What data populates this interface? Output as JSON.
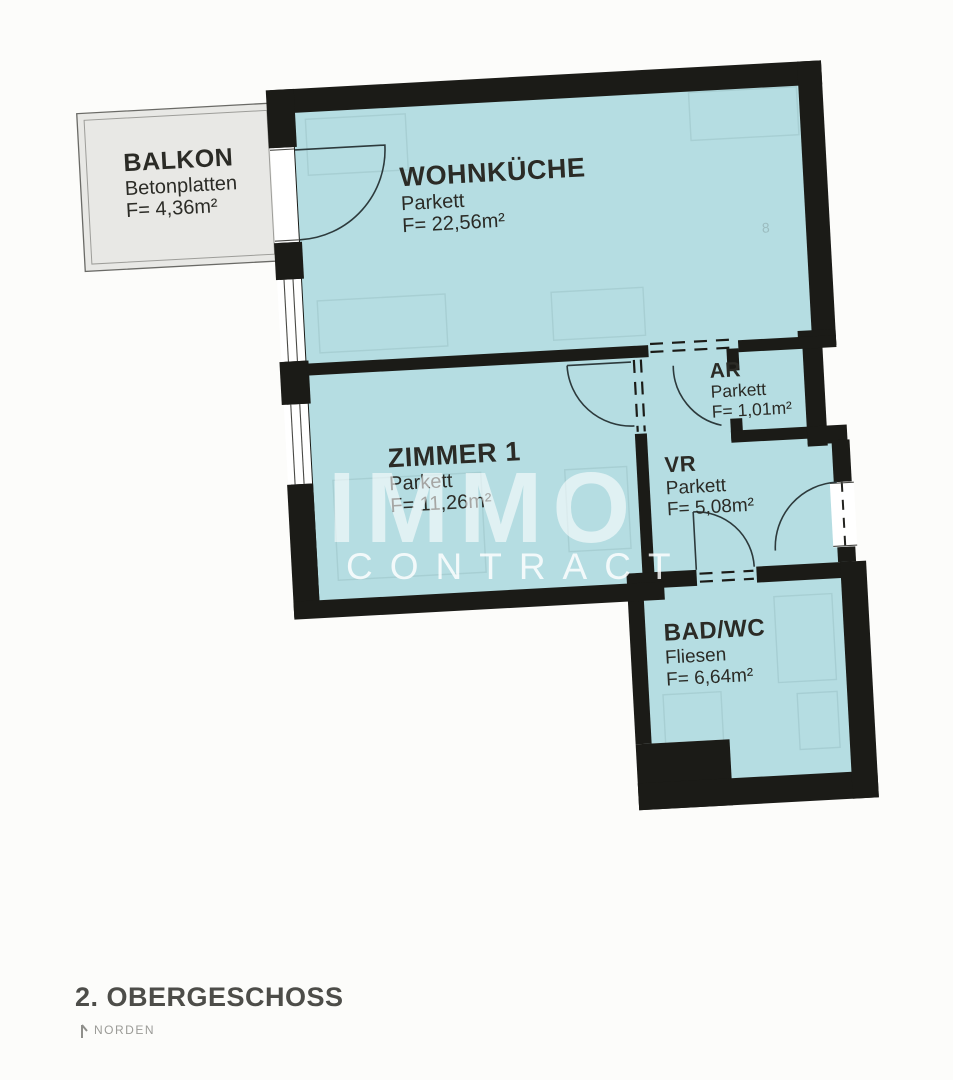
{
  "plan": {
    "watermark": {
      "primary": "IMMO",
      "secondary": "CONTRACT"
    },
    "footer": {
      "floor_label": "2. OBERGESCHOSS",
      "north_label": "NORDEN"
    },
    "rooms": [
      {
        "id": "balkon",
        "name": "BALKON",
        "floor": "Betonplatten",
        "area": "F= 4,36m²"
      },
      {
        "id": "wohnkueche",
        "name": "WOHNKÜCHE",
        "floor": "Parkett",
        "area": "F= 22,56m²"
      },
      {
        "id": "zimmer1",
        "name": "ZIMMER 1",
        "floor": "Parkett",
        "area": "F= 11,26m²"
      },
      {
        "id": "ar",
        "name": "AR",
        "floor": "Parkett",
        "area": "F= 1,01m²"
      },
      {
        "id": "vr",
        "name": "VR",
        "floor": "Parkett",
        "area": "F= 5,08m²"
      },
      {
        "id": "badwc",
        "name": "BAD/WC",
        "floor": "Fliesen",
        "area": "F= 6,64m²"
      }
    ],
    "colors": {
      "background": "#fcfcfa",
      "room_fill": "#b5dde2",
      "wall": "#1b1b17",
      "balcony_fill": "#e8e8e5",
      "label_text": "#2b2b26",
      "floor_label_text": "#4d4d49",
      "north_text": "#9b9b97",
      "watermark_text": "#ffffff"
    }
  }
}
